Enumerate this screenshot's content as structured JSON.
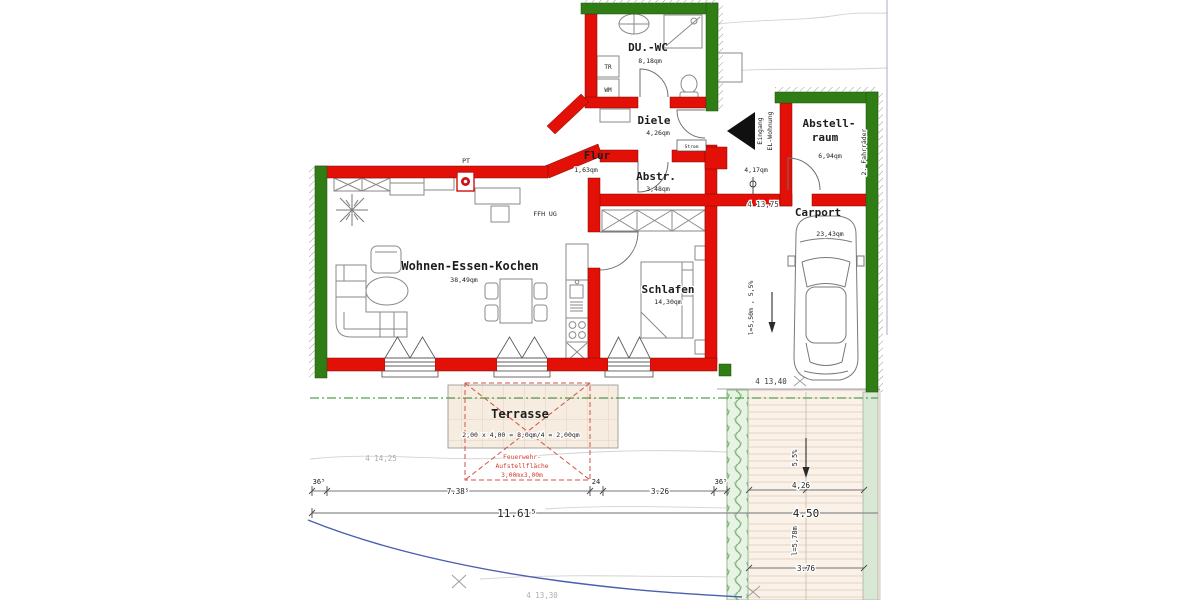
{
  "plan": {
    "rooms": {
      "duwc": {
        "name": "DU.-WC",
        "area": "8,18qm"
      },
      "diele": {
        "name": "Diele",
        "area": "4,26qm"
      },
      "flur": {
        "name": "Flur",
        "area": "1,63qm"
      },
      "abstr": {
        "name": "Abstr.",
        "area": "3,48qm"
      },
      "abstellraum": {
        "line1": "Abstell-",
        "line2": "raum",
        "area": "6,94qm"
      },
      "wohnen": {
        "name": "Wohnen-Essen-Kochen",
        "area": "38,49qm"
      },
      "schlafen": {
        "name": "Schlafen",
        "area": "14,30qm"
      },
      "carport": {
        "name": "Carport",
        "area": "23,43qm"
      },
      "terrasse": {
        "name": "Terrasse",
        "calc": "2,00 x 4,00 = 8,0qm/4 = 2,00qm"
      }
    },
    "annotations": {
      "pt": "PT",
      "ffh": "FFH  UG",
      "tr": "TR",
      "wm": "WM",
      "strom": "Strom",
      "eingang1": "Eingang",
      "eingang2": "EL-Wohnung",
      "entry_area": "4,17qm",
      "fahrraeder": "2. Fahrräder",
      "carport_slope": "l=5,50m , 5,5%",
      "drive_slope": "5,5%",
      "drive_len": "l=5,78m",
      "fw1": "Feuerwehr-",
      "fw2": "Aufstellfläche",
      "fw3": "3,00mx3,00m"
    },
    "elevations": {
      "top": "4 13,75",
      "carport_end": "4 13,40",
      "terrain_left": "4 14,25",
      "terrain_bottom": "4 13,30"
    },
    "dimensions": {
      "b1": "36⁵",
      "b2": "7.38⁵",
      "b3": "24",
      "b4": "3.26",
      "b5": "36⁵",
      "total": "11.61⁵",
      "d1": "4,26",
      "d2": "4.50",
      "d3": "3.76"
    },
    "colors": {
      "wall_new": "#e31007",
      "wall_existing": "#2f7d14"
    }
  }
}
